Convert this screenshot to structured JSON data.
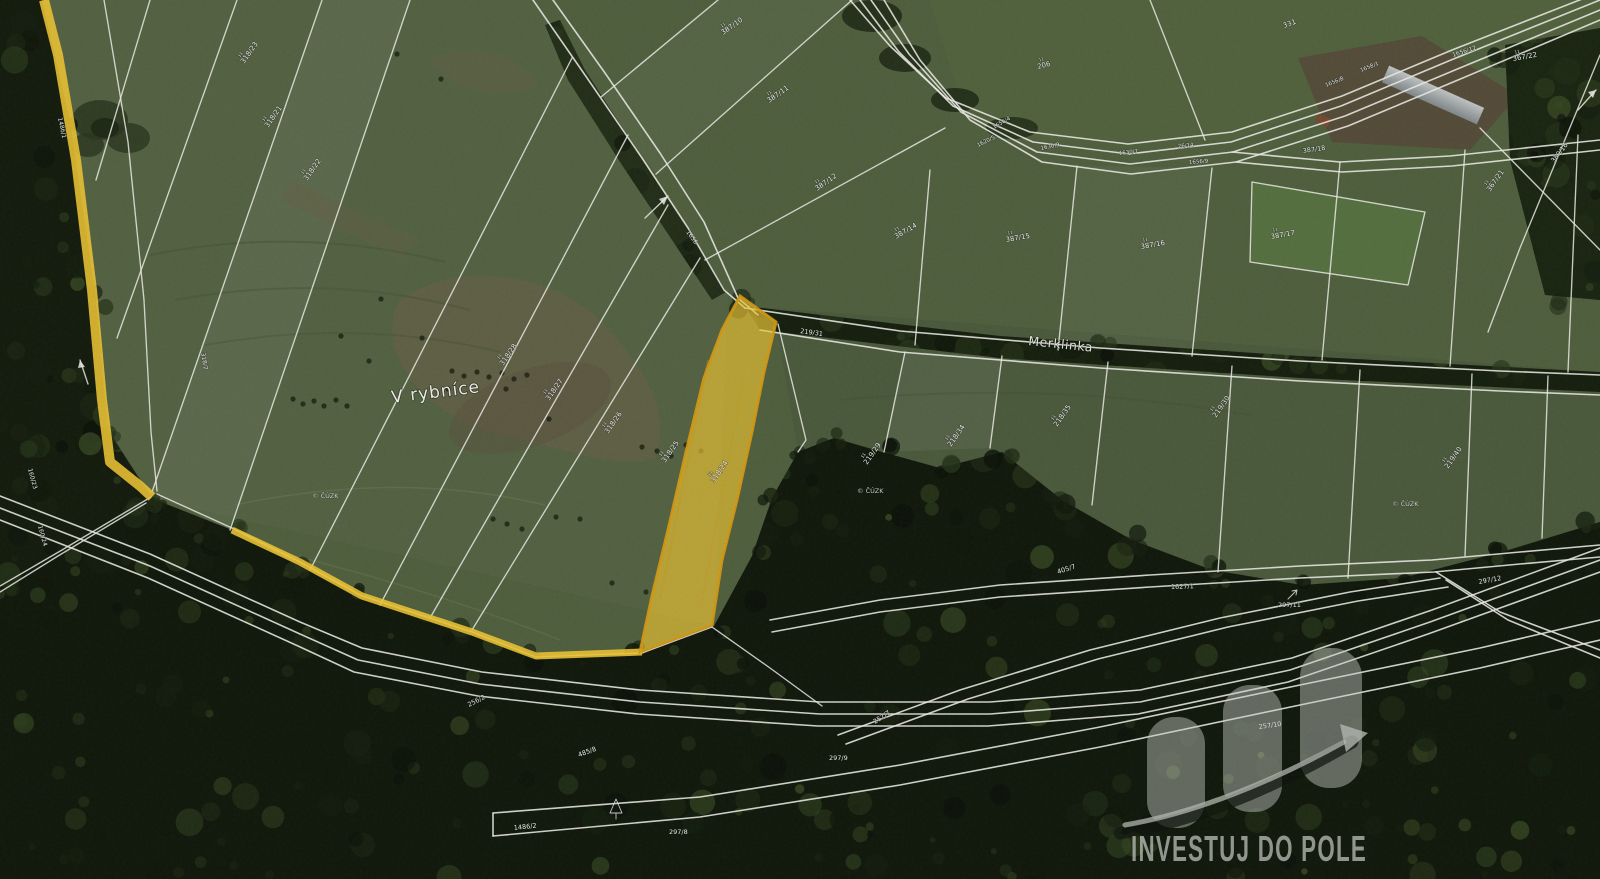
{
  "map": {
    "colors": {
      "highlight": "#f3c834",
      "highlight_stroke": "#d89d15",
      "boundary_line": "#f0f0ea"
    },
    "place_labels": [
      {
        "t": "V rybníce",
        "x": 392,
        "y": 403,
        "r": -7,
        "s": 17,
        "cls": "place",
        "name": "place-label-v-rybnice"
      },
      {
        "t": "Merklinka",
        "x": 1028,
        "y": 345,
        "r": 6,
        "s": 12.5,
        "cls": "stream",
        "name": "stream-label-merklinka"
      }
    ],
    "parcel_labels": [
      {
        "t": "318/23",
        "x": 244,
        "y": 64,
        "r": -55,
        "s": 7,
        "k": 1
      },
      {
        "t": "318/21",
        "x": 268,
        "y": 128,
        "r": -55,
        "s": 7,
        "k": 1
      },
      {
        "t": "318/22",
        "x": 307,
        "y": 181,
        "r": -55,
        "s": 7,
        "k": 1
      },
      {
        "t": "318/28",
        "x": 503,
        "y": 366,
        "r": -55,
        "s": 7,
        "k": 1
      },
      {
        "t": "318/27",
        "x": 549,
        "y": 401,
        "r": -55,
        "s": 7,
        "k": 1
      },
      {
        "t": "318/26",
        "x": 608,
        "y": 434,
        "r": -55,
        "s": 7,
        "k": 1
      },
      {
        "t": "318/25",
        "x": 665,
        "y": 463,
        "r": -55,
        "s": 7,
        "k": 1
      },
      {
        "t": "318/24",
        "x": 714,
        "y": 483,
        "r": -55,
        "s": 7,
        "k": 1
      },
      {
        "t": "219/31",
        "x": 800,
        "y": 333,
        "r": 8,
        "s": 6.5
      },
      {
        "t": "219/29",
        "x": 867,
        "y": 465,
        "r": -55,
        "s": 7,
        "k": 1
      },
      {
        "t": "218/34",
        "x": 951,
        "y": 447,
        "r": -55,
        "s": 7,
        "k": 1
      },
      {
        "t": "218/35",
        "x": 1057,
        "y": 427,
        "r": -55,
        "s": 7,
        "k": 1
      },
      {
        "t": "219/30",
        "x": 1216,
        "y": 418,
        "r": -55,
        "s": 7,
        "k": 1
      },
      {
        "t": "219/40",
        "x": 1448,
        "y": 469,
        "r": -55,
        "s": 7,
        "k": 1
      },
      {
        "t": "387/10",
        "x": 723,
        "y": 35,
        "r": -35,
        "s": 7,
        "k": 1
      },
      {
        "t": "387/11",
        "x": 769,
        "y": 103,
        "r": -35,
        "s": 7,
        "k": 1
      },
      {
        "t": "387/12",
        "x": 817,
        "y": 191,
        "r": -35,
        "s": 7,
        "k": 1
      },
      {
        "t": "387/14",
        "x": 896,
        "y": 239,
        "r": -30,
        "s": 7,
        "k": 1
      },
      {
        "t": "387/15",
        "x": 1006,
        "y": 242,
        "r": -10,
        "s": 7,
        "k": 1
      },
      {
        "t": "387/16",
        "x": 1141,
        "y": 249,
        "r": -10,
        "s": 7,
        "k": 1
      },
      {
        "t": "387/17",
        "x": 1271,
        "y": 239,
        "r": -10,
        "s": 7,
        "k": 1
      },
      {
        "t": "387/18",
        "x": 1303,
        "y": 153,
        "r": -8,
        "s": 6.5
      },
      {
        "t": "206",
        "x": 1038,
        "y": 69,
        "r": -15,
        "s": 7,
        "k": 1
      },
      {
        "t": "331",
        "x": 1284,
        "y": 28,
        "r": -20,
        "s": 7
      },
      {
        "t": "1656/12",
        "x": 1453,
        "y": 57,
        "r": -18,
        "s": 6
      },
      {
        "t": "367/22",
        "x": 1513,
        "y": 61,
        "r": -10,
        "s": 7,
        "k": 1
      },
      {
        "t": "367/21",
        "x": 1490,
        "y": 192,
        "r": -55,
        "s": 7,
        "k": 1
      },
      {
        "t": "380/16",
        "x": 1554,
        "y": 163,
        "r": -52,
        "s": 6.5
      },
      {
        "t": "1656/4",
        "x": 994,
        "y": 129,
        "r": -30,
        "s": 5.5
      },
      {
        "t": "1620/5",
        "x": 978,
        "y": 147,
        "r": -26,
        "s": 5.5
      },
      {
        "t": "1630/9",
        "x": 1041,
        "y": 150,
        "r": -12,
        "s": 5.5
      },
      {
        "t": "1630/7",
        "x": 1119,
        "y": 155,
        "r": -6,
        "s": 5.5
      },
      {
        "t": "26/14",
        "x": 1178,
        "y": 148,
        "r": -6,
        "s": 5.5
      },
      {
        "t": "1656/9",
        "x": 1189,
        "y": 164,
        "r": -4,
        "s": 5.5
      },
      {
        "t": "1658/1",
        "x": 1361,
        "y": 72,
        "r": -22,
        "s": 5.5
      },
      {
        "t": "1656/8",
        "x": 1326,
        "y": 87,
        "r": -22,
        "s": 5.5
      },
      {
        "t": "1656",
        "x": 686,
        "y": 232,
        "r": 55,
        "s": 6
      },
      {
        "t": "1486/1",
        "x": 58,
        "y": 118,
        "r": 78,
        "s": 6
      },
      {
        "t": "318/2",
        "x": 201,
        "y": 353,
        "r": 80,
        "s": 6
      },
      {
        "t": "160/23",
        "x": 28,
        "y": 469,
        "r": 75,
        "s": 6
      },
      {
        "t": "160/24",
        "x": 38,
        "y": 526,
        "r": 75,
        "s": 6
      },
      {
        "t": "1486/2",
        "x": 514,
        "y": 830,
        "r": -6,
        "s": 6.5
      },
      {
        "t": "485/8",
        "x": 579,
        "y": 757,
        "r": -20,
        "s": 6.5
      },
      {
        "t": "256/2",
        "x": 469,
        "y": 707,
        "r": -27,
        "s": 6.5
      },
      {
        "t": "257/7",
        "x": 875,
        "y": 724,
        "r": -33,
        "s": 6.5
      },
      {
        "t": "297/8",
        "x": 669,
        "y": 834,
        "r": 0,
        "s": 6.5
      },
      {
        "t": "297/9",
        "x": 829,
        "y": 760,
        "r": 0,
        "s": 6.5
      },
      {
        "t": "257/10",
        "x": 1259,
        "y": 729,
        "r": -8,
        "s": 6.5
      },
      {
        "t": "297/11",
        "x": 1278,
        "y": 607,
        "r": 0,
        "s": 6.5
      },
      {
        "t": "1627/1",
        "x": 1171,
        "y": 589,
        "r": -2,
        "s": 6.5
      },
      {
        "t": "405/7",
        "x": 1058,
        "y": 574,
        "r": -18,
        "s": 6.5
      },
      {
        "t": "297/12",
        "x": 1479,
        "y": 584,
        "r": -10,
        "s": 6.5
      }
    ],
    "copyright_watermarks": [
      {
        "t": "© ČÚZK",
        "x": 312,
        "y": 498,
        "s": 6.5
      },
      {
        "t": "© ČÚZK",
        "x": 857,
        "y": 493,
        "s": 6.5
      },
      {
        "t": "© ČÚZK",
        "x": 1392,
        "y": 506,
        "s": 6.5
      }
    ]
  },
  "logo": {
    "text": "INVESTUJ DO POLE",
    "color": "#c6c9c2"
  }
}
